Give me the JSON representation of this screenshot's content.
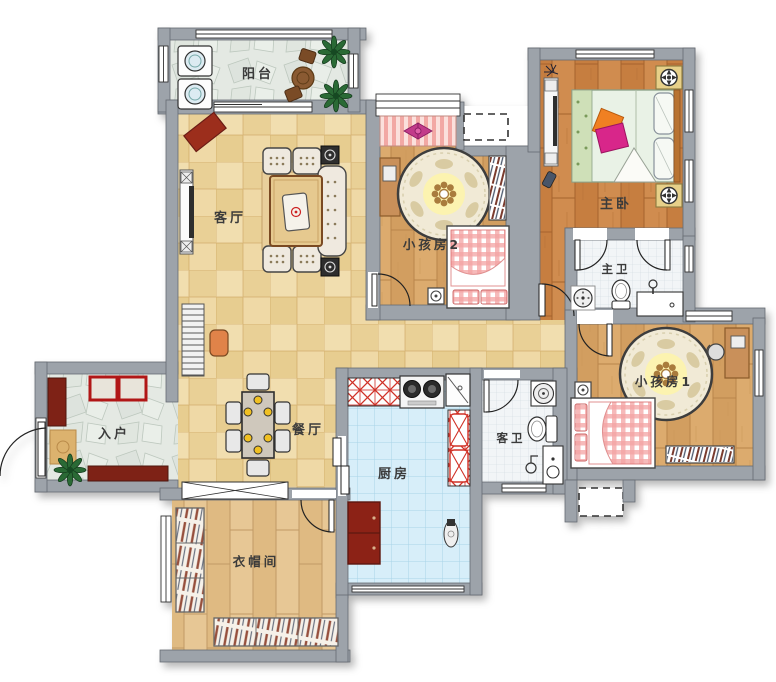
{
  "plan": {
    "title": "三室两厅户型图",
    "rooms": [
      {
        "id": "balcony",
        "label": "阳台"
      },
      {
        "id": "living",
        "label": "客厅"
      },
      {
        "id": "kids2",
        "label": "小孩房2"
      },
      {
        "id": "master",
        "label": "主卧"
      },
      {
        "id": "master_bath",
        "label": "主卫"
      },
      {
        "id": "kids1",
        "label": "小孩房1"
      },
      {
        "id": "guest_bath",
        "label": "客卫"
      },
      {
        "id": "kitchen",
        "label": "厨房"
      },
      {
        "id": "dining",
        "label": "餐厅"
      },
      {
        "id": "entry",
        "label": "入户"
      },
      {
        "id": "cloakroom",
        "label": "衣帽间"
      }
    ],
    "colors": {
      "wall": "#9da3aa",
      "wall_edge": "#666b72",
      "tile_tan": "#ecd5a0",
      "stone": "#e4e9e3",
      "wood_kids": "#d7a566",
      "wood_master": "#cc8748",
      "wood_cloak": "#e3c28e",
      "tile_blue": "#d7eef9",
      "tile_bath": "#f2f5f7",
      "counter_hatch_red": "#d03028",
      "cabinet_red": "#8c2418",
      "bed_gingham_pink": "#f2a3a3",
      "pillow_orange": "#f08020",
      "pillow_magenta": "#d8258a",
      "plant_green": "#2c6a36"
    }
  }
}
